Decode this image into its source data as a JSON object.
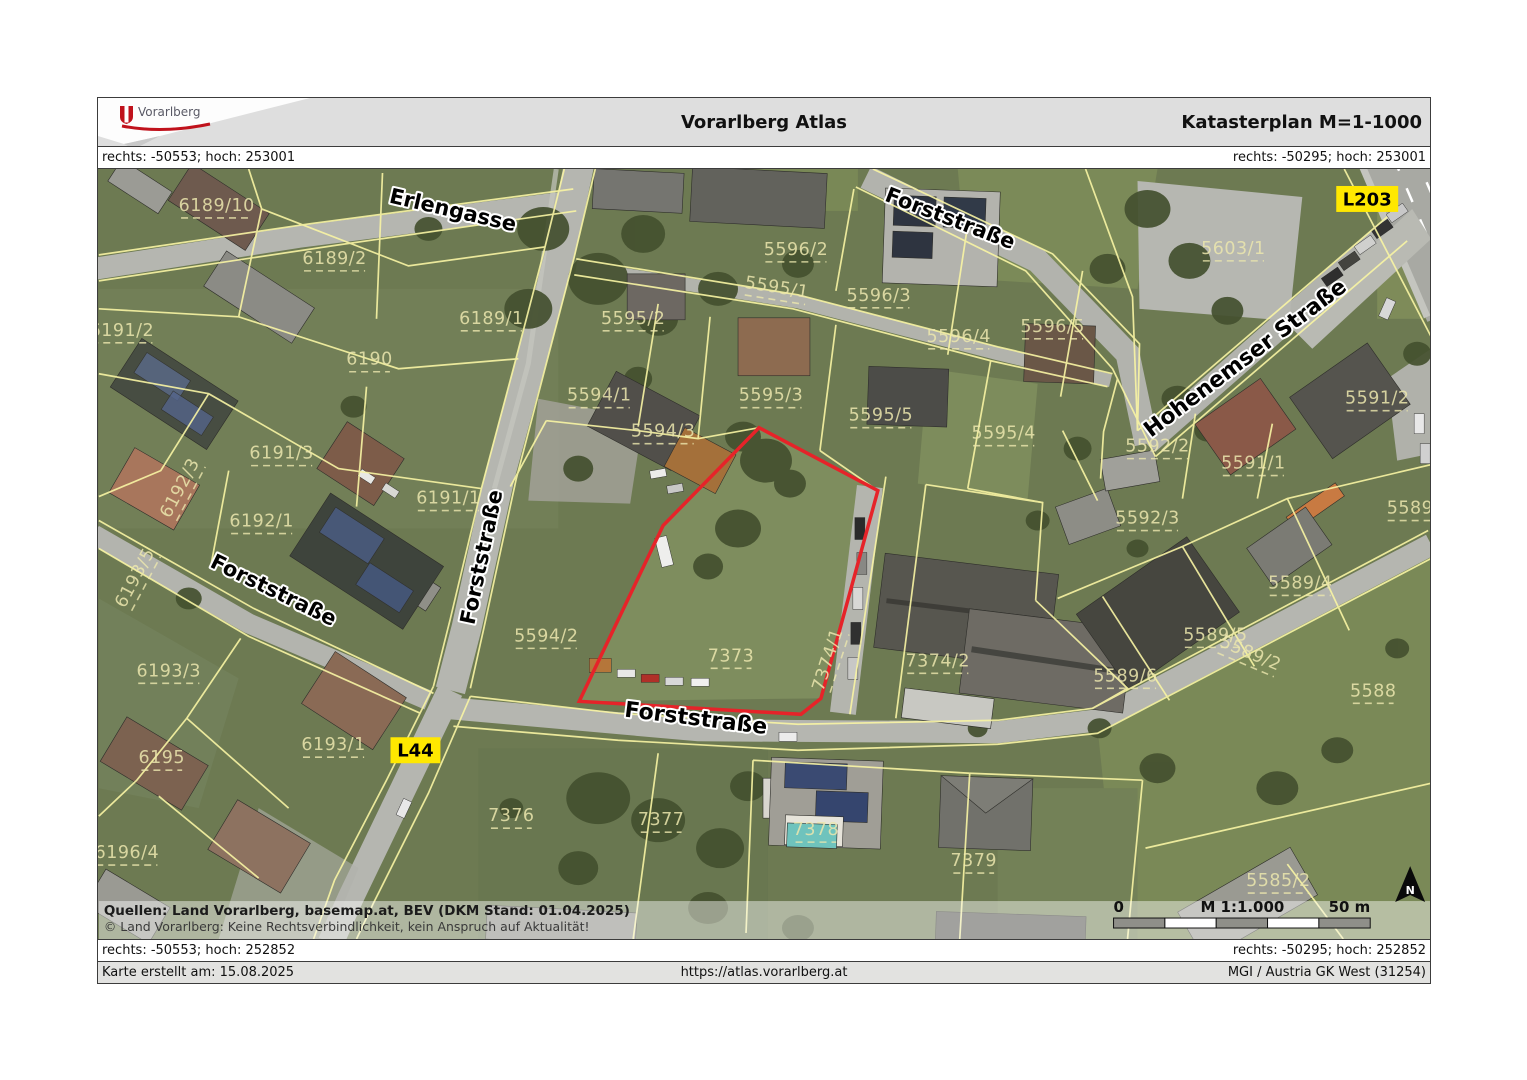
{
  "header": {
    "logo_text": "Vorarlberg",
    "title": "Vorarlberg Atlas",
    "subtitle": "Katasterplan M=1-1000"
  },
  "coordinates": {
    "top_left": "rechts: -50553; hoch: 253001",
    "top_right": "rechts: -50295; hoch: 253001",
    "bottom_left": "rechts: -50553; hoch: 252852",
    "bottom_right": "rechts: -50295; hoch: 252852"
  },
  "map": {
    "highlighted_parcel": "7373",
    "highlight_color": "#e62329",
    "parcel_label_color": "#ece7ae",
    "badge_color": "#ffe800",
    "streets": [
      {
        "label": "Erlengasse",
        "x": 353,
        "y": 48,
        "rot": 13,
        "size": 21
      },
      {
        "label": "Forststraße",
        "x": 850,
        "y": 56,
        "rot": 21,
        "size": 21
      },
      {
        "label": "Forststraße",
        "x": 390,
        "y": 390,
        "rot": -78,
        "size": 21
      },
      {
        "label": "Forststraße",
        "x": 172,
        "y": 428,
        "rot": 26,
        "size": 21
      },
      {
        "label": "Forststraße",
        "x": 597,
        "y": 557,
        "rot": 7,
        "size": 22
      },
      {
        "label": "Hohenemser Straße",
        "x": 1152,
        "y": 195,
        "rot": -37,
        "size": 22
      }
    ],
    "road_badges": [
      {
        "label": "L203",
        "x": 1270,
        "y": 30
      },
      {
        "label": "L44",
        "x": 317,
        "y": 582
      }
    ],
    "parcels": [
      {
        "label": "6189/10",
        "x": 118,
        "y": 42
      },
      {
        "label": "6189/2",
        "x": 236,
        "y": 95
      },
      {
        "label": "6189/1",
        "x": 393,
        "y": 155
      },
      {
        "label": "6190",
        "x": 271,
        "y": 196
      },
      {
        "label": "6191/2",
        "x": 23,
        "y": 167
      },
      {
        "label": "6191/3",
        "x": 183,
        "y": 290
      },
      {
        "label": "6192/3",
        "x": 86,
        "y": 322,
        "rot": -62
      },
      {
        "label": "6192/1",
        "x": 163,
        "y": 358
      },
      {
        "label": "6191/1",
        "x": 350,
        "y": 335
      },
      {
        "label": "6193/5",
        "x": 41,
        "y": 412,
        "rot": -62
      },
      {
        "label": "6193/3",
        "x": 70,
        "y": 508
      },
      {
        "label": "6193/1",
        "x": 235,
        "y": 582
      },
      {
        "label": "6195",
        "x": 63,
        "y": 595
      },
      {
        "label": "6196/4",
        "x": 28,
        "y": 690
      },
      {
        "label": "5595/2",
        "x": 535,
        "y": 155
      },
      {
        "label": "5596/2",
        "x": 698,
        "y": 86
      },
      {
        "label": "5595/1",
        "x": 678,
        "y": 124,
        "rot": 9
      },
      {
        "label": "5596/3",
        "x": 781,
        "y": 132
      },
      {
        "label": "5596/4",
        "x": 861,
        "y": 173
      },
      {
        "label": "5596/5",
        "x": 955,
        "y": 163
      },
      {
        "label": "5594/1",
        "x": 501,
        "y": 232
      },
      {
        "label": "5595/3",
        "x": 673,
        "y": 232
      },
      {
        "label": "5594/3",
        "x": 565,
        "y": 268
      },
      {
        "label": "5595/5",
        "x": 783,
        "y": 252
      },
      {
        "label": "5595/4",
        "x": 906,
        "y": 270
      },
      {
        "label": "5594/2",
        "x": 448,
        "y": 473
      },
      {
        "label": "7373",
        "x": 633,
        "y": 493
      },
      {
        "label": "7374/1",
        "x": 735,
        "y": 493,
        "rot": -72
      },
      {
        "label": "7374/2",
        "x": 840,
        "y": 498
      },
      {
        "label": "5603/1",
        "x": 1136,
        "y": 85
      },
      {
        "label": "5591/2",
        "x": 1280,
        "y": 235
      },
      {
        "label": "5592/2",
        "x": 1060,
        "y": 283
      },
      {
        "label": "5591/1",
        "x": 1156,
        "y": 300
      },
      {
        "label": "5592/3",
        "x": 1050,
        "y": 355
      },
      {
        "label": "5589/",
        "x": 1316,
        "y": 345
      },
      {
        "label": "5589/4",
        "x": 1203,
        "y": 420
      },
      {
        "label": "5589/5",
        "x": 1118,
        "y": 472
      },
      {
        "label": "5589/2",
        "x": 1151,
        "y": 490,
        "rot": 23
      },
      {
        "label": "5589/6",
        "x": 1028,
        "y": 513
      },
      {
        "label": "5588",
        "x": 1276,
        "y": 528
      },
      {
        "label": "5585/2",
        "x": 1181,
        "y": 718
      },
      {
        "label": "7376",
        "x": 413,
        "y": 653
      },
      {
        "label": "7377",
        "x": 563,
        "y": 657
      },
      {
        "label": "7378",
        "x": 718,
        "y": 667
      },
      {
        "label": "7379",
        "x": 876,
        "y": 698
      }
    ],
    "sources_line1": "Quellen: Land Vorarlberg, basemap.at, BEV (DKM Stand: 01.04.2025)",
    "sources_line2": "© Land Vorarlberg: Keine Rechtsverbindlichkeit, kein Anspruch auf Aktualität!",
    "scale": {
      "zero": "0",
      "label": "M 1:1.000",
      "max": "50 m"
    },
    "north_label": "N"
  },
  "footer": {
    "created": "Karte erstellt am: 15.08.2025",
    "url": "https://atlas.vorarlberg.at",
    "crs": "MGI / Austria GK West (31254)"
  }
}
